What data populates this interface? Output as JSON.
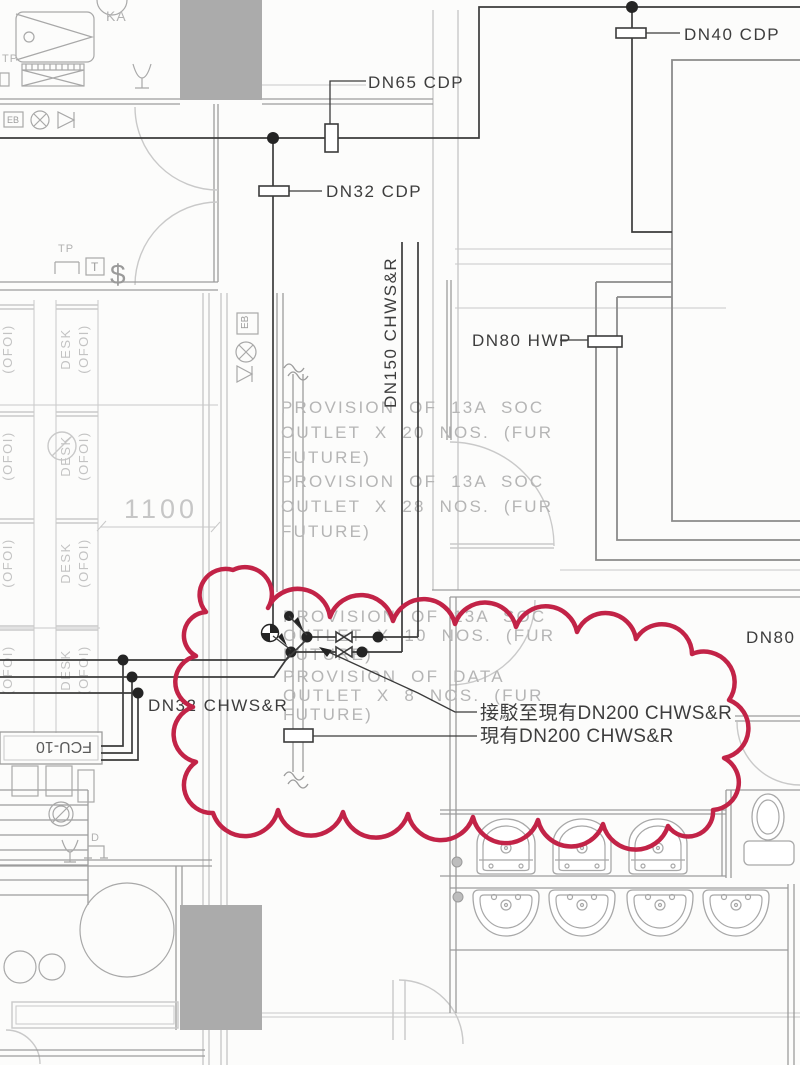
{
  "labels": {
    "dn65_cdp": "DN65 CDP",
    "dn32_cdp": "DN32 CDP",
    "dn40_cdp": "DN40 CDP",
    "dn80_hwp": "DN80 HWP",
    "dn150_chwsr": "DN150 CHWS&R",
    "dn32_chwsr": "DN32 CHWS&R",
    "dn80_h_clipped": "DN80 H",
    "connect_to_existing": "接駁至現有DN200 CHWS&R",
    "existing_main": "現有DN200 CHWS&R",
    "fcu": "FCU-10",
    "ka": "KA",
    "eb": "EB",
    "tp": "TP",
    "t": "T",
    "d": "D",
    "dollar": "$",
    "desk": "DESK",
    "ofoi": "(OFOI)",
    "dim_1100": "1100"
  },
  "provisions": {
    "p1": {
      "l1": "PROVISION OF 13A SOC",
      "l2": "OUTLET X 20 NOS. (FUR",
      "l3": "FUTURE)"
    },
    "p2": {
      "l1": "PROVISION OF 13A SOC",
      "l2": "OUTLET X 28 NOS. (FUR",
      "l3": "FUTURE)"
    },
    "p3": {
      "l1": "PROVISION OF 13A SOC",
      "l2": "OUTLET X 10 NOS. (FUR",
      "l3": "FUTURE)"
    },
    "p4": {
      "l1": "PROVISION OF DATA",
      "l2": "OUTLET X 8 NOS. (FUR",
      "l3": "FUTURE)"
    }
  },
  "colors": {
    "revision_cloud": "#c22347",
    "pipe": "#3b3b3b",
    "wall": "#9c9c9c",
    "faint": "#c9c9c9",
    "gray_text": "#b5b5b5",
    "label_text": "#3d3d3d",
    "column_fill": "#ababab"
  }
}
